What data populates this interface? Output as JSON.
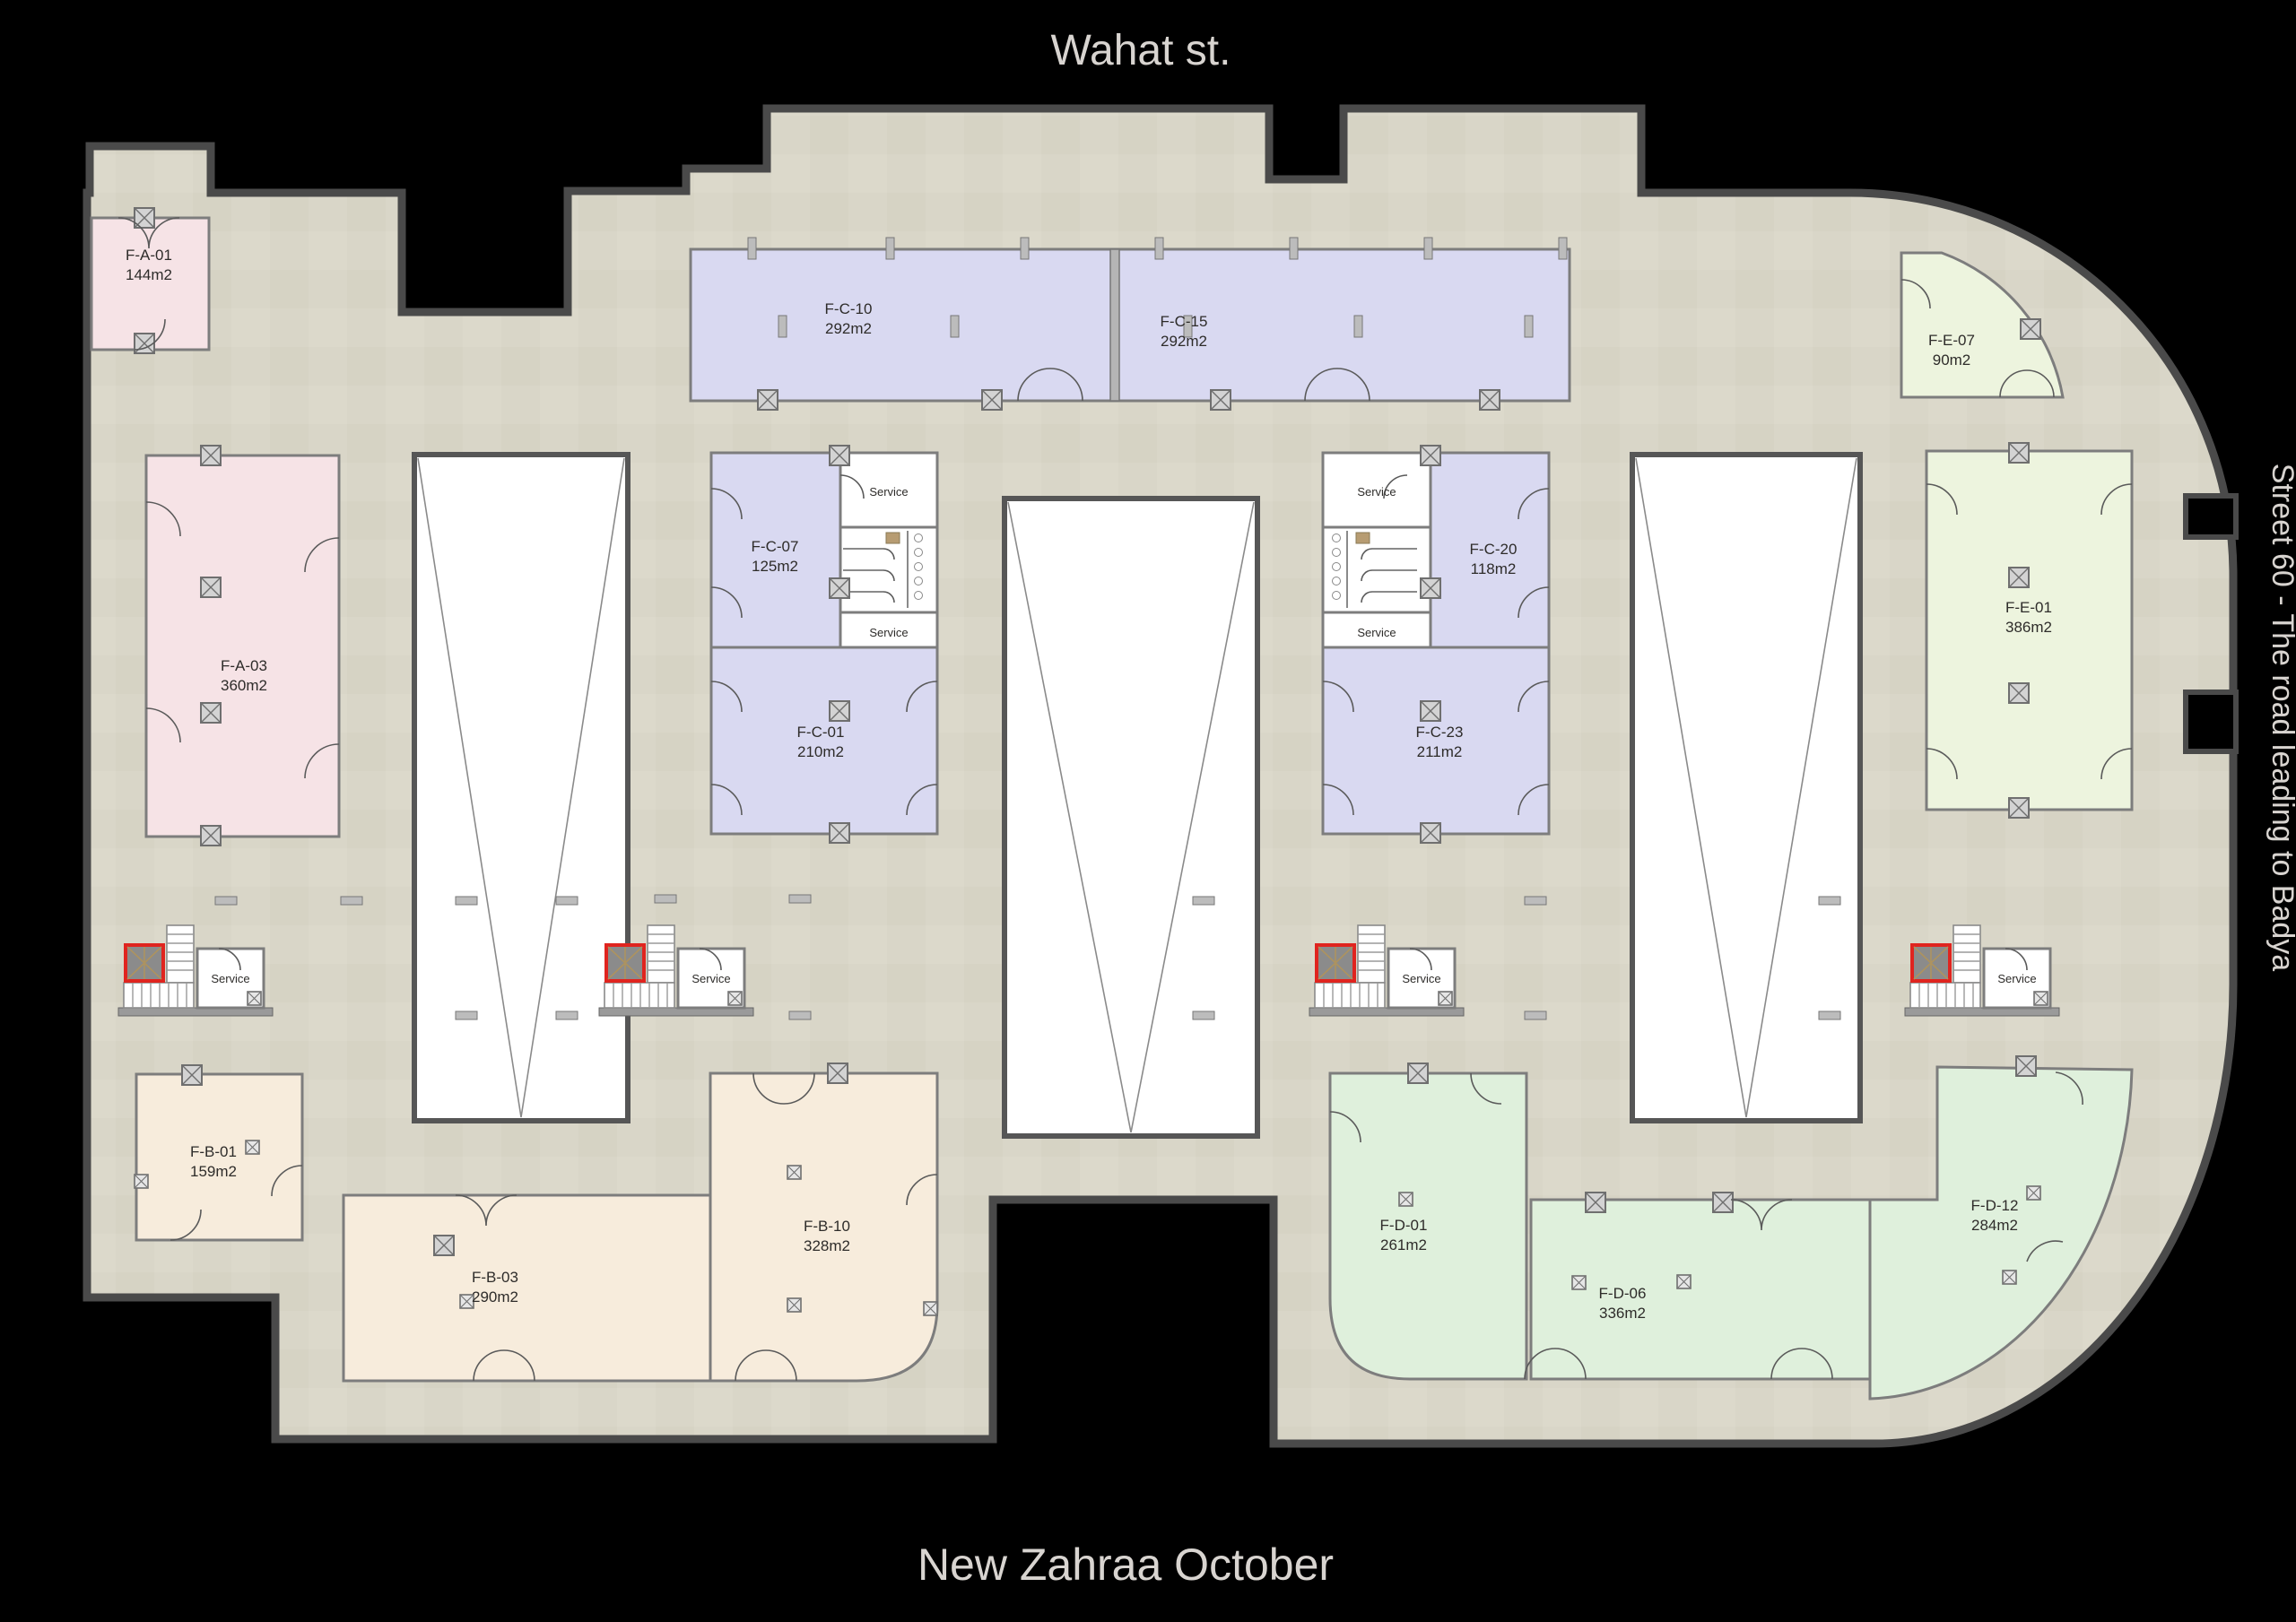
{
  "titles": {
    "top": "Wahat st.",
    "bottom": "New Zahraa October",
    "right_street": "Street 60 - The road leading to Badya"
  },
  "labels": {
    "service": "Service"
  },
  "units": {
    "fa01": {
      "name": "F-A-01",
      "area": "144m2"
    },
    "fa03": {
      "name": "F-A-03",
      "area": "360m2"
    },
    "fb01": {
      "name": "F-B-01",
      "area": "159m2"
    },
    "fb03": {
      "name": "F-B-03",
      "area": "290m2"
    },
    "fb10": {
      "name": "F-B-10",
      "area": "328m2"
    },
    "fc01": {
      "name": "F-C-01",
      "area": "210m2"
    },
    "fc07": {
      "name": "F-C-07",
      "area": "125m2"
    },
    "fc10": {
      "name": "F-C-10",
      "area": "292m2"
    },
    "fc15": {
      "name": "F-C-15",
      "area": "292m2"
    },
    "fc20": {
      "name": "F-C-20",
      "area": "118m2"
    },
    "fc23": {
      "name": "F-C-23",
      "area": "211m2"
    },
    "fd01": {
      "name": "F-D-01",
      "area": "261m2"
    },
    "fd06": {
      "name": "F-D-06",
      "area": "336m2"
    },
    "fd12": {
      "name": "F-D-12",
      "area": "284m2"
    },
    "fe01": {
      "name": "F-E-01",
      "area": "386m2"
    },
    "fe07": {
      "name": "F-E-07",
      "area": "90m2"
    }
  },
  "colors": {
    "background": "#000000",
    "floor": "#d9d6c8",
    "outer_wall": "#4a4a4a",
    "unit_pink": "#f6e3e6",
    "unit_lavender": "#d9d9f1",
    "unit_beige": "#f7ecdc",
    "unit_green": "#dff0dc",
    "unit_pale_green": "#edf4de",
    "fire_elevator_accent": "#e0241f",
    "street_text": "#d8d4d0"
  }
}
